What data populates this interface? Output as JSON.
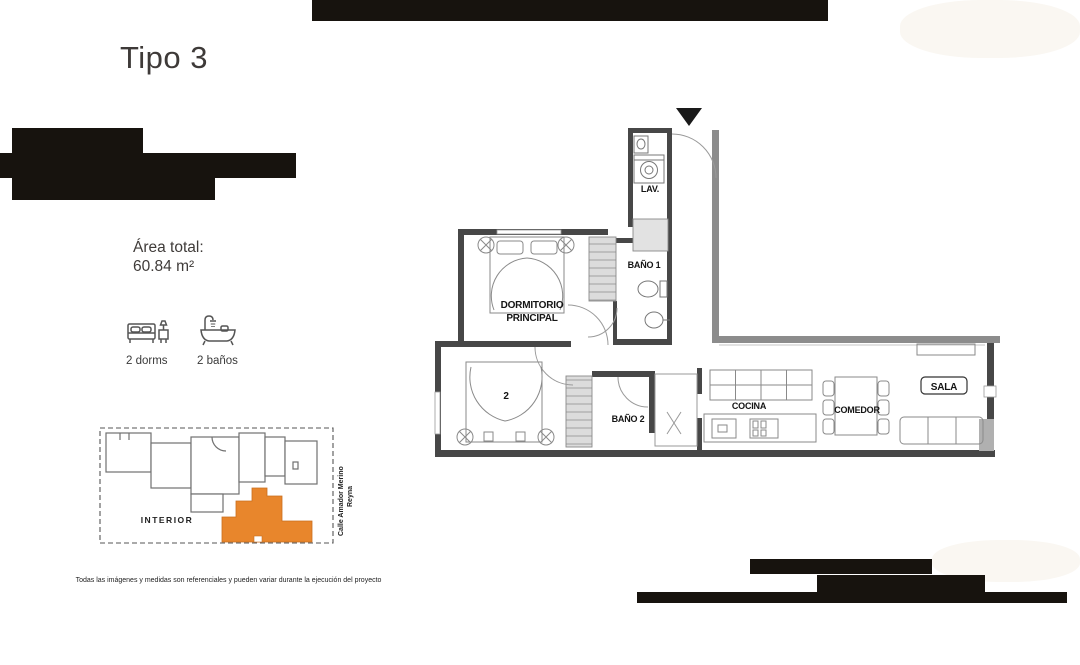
{
  "header": {
    "title": "Tipo 3"
  },
  "summary": {
    "area_label": "Área total:",
    "area_value": "60.84 m²",
    "features": [
      {
        "icon": "bed-icon",
        "label": "2 dorms"
      },
      {
        "icon": "bathtub-icon",
        "label": "2 baños"
      }
    ]
  },
  "site_map": {
    "interior_label": "INTERIOR",
    "street_name": [
      "Calle Amador Merino",
      "Reyna"
    ],
    "unit_highlight_color": "#E8862C"
  },
  "floor_plan": {
    "rooms": {
      "lav": "LAV.",
      "bano1": "BAÑO 1",
      "dormitorio_principal": [
        "DORMITORIO",
        "PRINCIPAL"
      ],
      "dormitorio2": "2",
      "bano2": "BAÑO 2",
      "cocina": "COCINA",
      "comedor": "COMEDOR",
      "sala": "SALA"
    }
  },
  "disclaimer": "Todas las imágenes y medidas son referenciales y pueden variar durante la ejecución del proyecto",
  "colors": {
    "redaction_bar": "#17130e"
  }
}
